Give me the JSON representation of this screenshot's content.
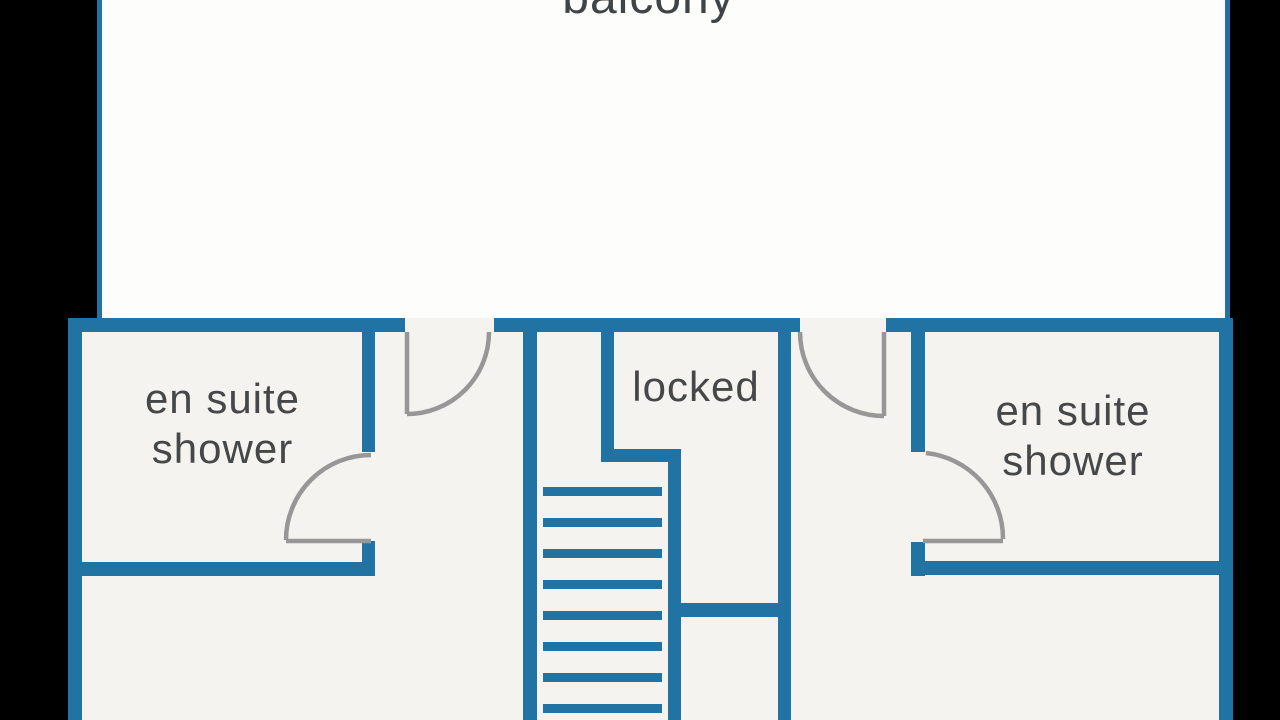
{
  "balcony": {
    "label": "balcony"
  },
  "rooms": {
    "left_ensuite": {
      "line1": "en suite",
      "line2": "shower"
    },
    "locked": {
      "label": "locked"
    },
    "right_ensuite": {
      "line1": "en suite",
      "line2": "shower"
    }
  },
  "colors": {
    "wall_blue": "#2173a3",
    "floor_fill": "#f4f3f0",
    "balcony_fill": "#fdfdfc",
    "door_gray": "#979797",
    "label_text": "#454748",
    "letterbox": "#000000"
  }
}
